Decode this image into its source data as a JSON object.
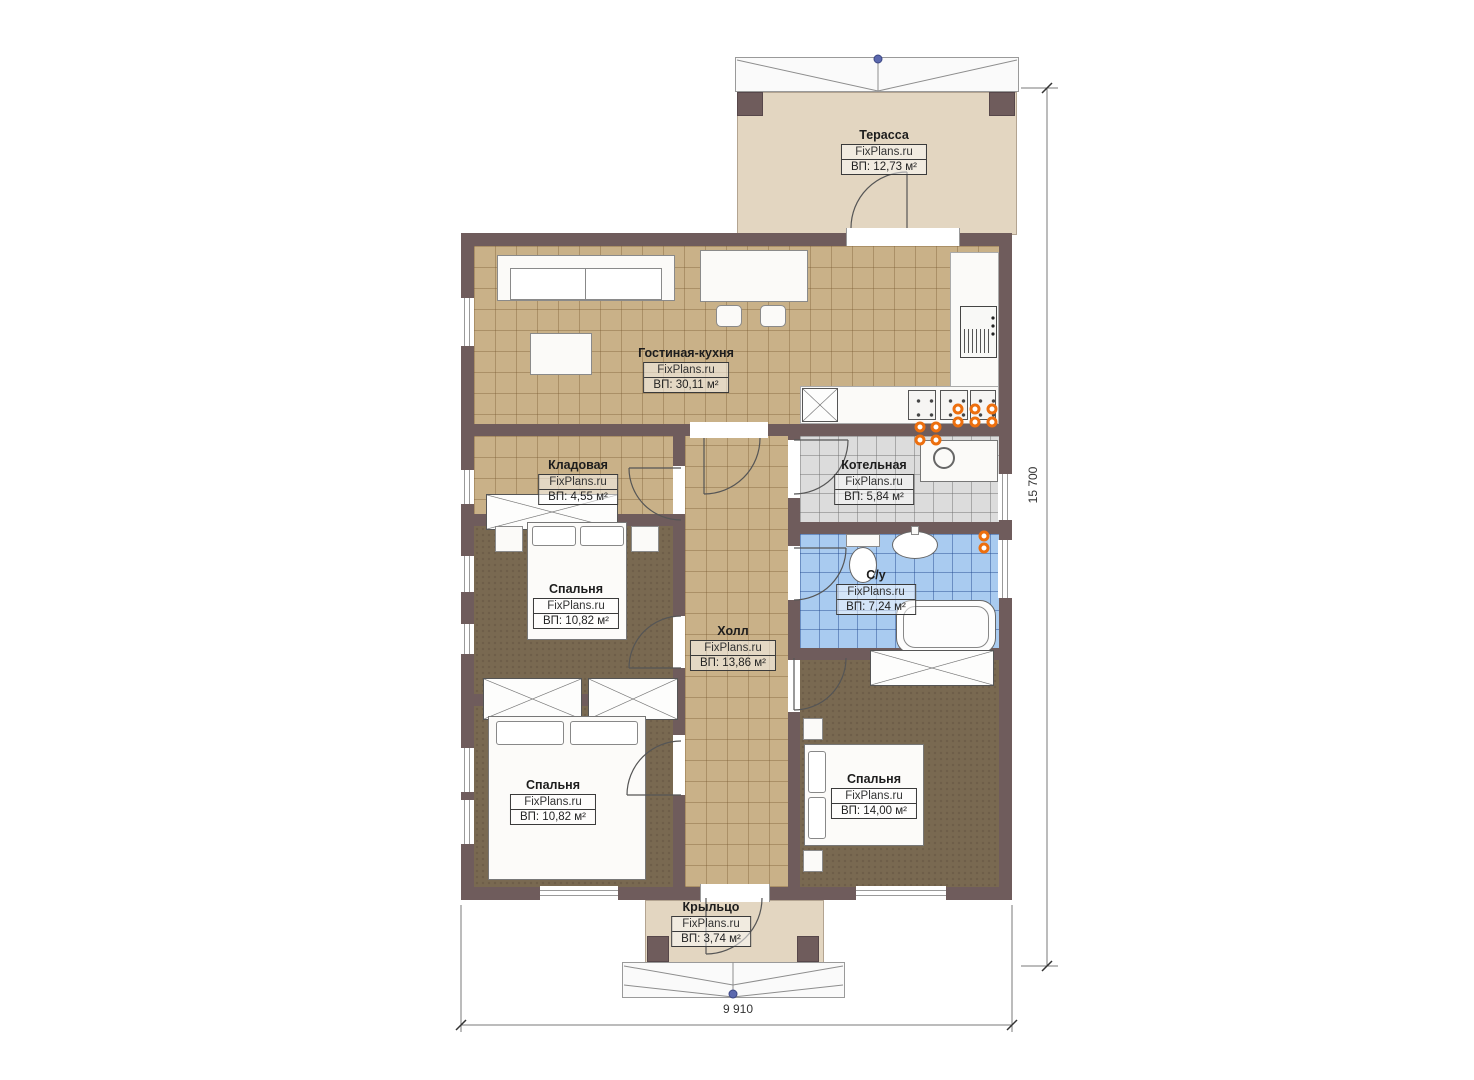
{
  "watermark": "FixPlans.ru",
  "rooms": {
    "terrace": {
      "name": "Терасса",
      "area": "ВП: 12,73 м²"
    },
    "living": {
      "name": "Гостиная-кухня",
      "area": "ВП: 30,11 м²"
    },
    "storage": {
      "name": "Кладовая",
      "area": "ВП: 4,55 м²"
    },
    "boiler": {
      "name": "Котельная",
      "area": "ВП: 5,84 м²"
    },
    "bedroom1": {
      "name": "Спальня",
      "area": "ВП: 10,82 м²"
    },
    "bathroom": {
      "name": "С/у",
      "area": "ВП: 7,24 м²"
    },
    "hall": {
      "name": "Холл",
      "area": "ВП: 13,86 м²"
    },
    "bedroom2": {
      "name": "Спальня",
      "area": "ВП: 10,82 м²"
    },
    "bedroom3": {
      "name": "Спальня",
      "area": "ВП: 14,00 м²"
    },
    "porch": {
      "name": "Крыльцо",
      "area": "ВП: 3,74 м²"
    }
  },
  "dimensions": {
    "vertical": "15 700",
    "horizontal": "9 910"
  },
  "colors": {
    "wall": "#6f5c5c",
    "tile_tan": "#c9b188",
    "carpet": "#796951",
    "tile_gray": "#dcdcdc",
    "tile_blue": "#a9cbf0",
    "deck": "#e3d6c1",
    "lamp": "#ed6f0e",
    "survey_dot": "#5b68ae"
  }
}
